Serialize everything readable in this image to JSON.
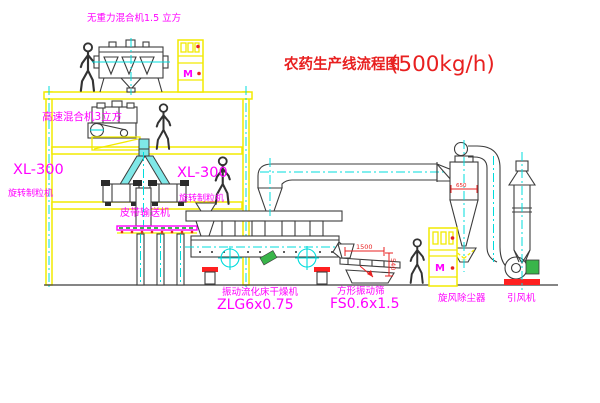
{
  "title": {
    "text": "农药生产线流程图",
    "capacity": "(500kg/h)"
  },
  "labels": {
    "zero_gravity_mixer": "无重力混合机1.5 立方",
    "high_speed_mixer": "高速混合机3立方",
    "granulator_left_model": "XL-300",
    "granulator_left_name": "旋转制粒机",
    "granulator_right_model": "XL-300",
    "granulator_right_name": "旋转制粒机",
    "belt_conveyor": "皮带输送机",
    "dryer_name": "振动流化床干燥机",
    "dryer_model": "ZLG6x0.75",
    "screen_name": "方形振动筛",
    "screen_model": "FS0.6x1.5",
    "cyclone": "旋风除尘器",
    "fan": "引风机",
    "cabinet_a_marking": "M",
    "cabinet_b_marking": "M"
  },
  "dimensions": {
    "screen_length": "1500",
    "screen_height": "540",
    "cyclone_diameter": "650"
  },
  "colors": {
    "building_yellow": "#f2ea00",
    "label_magenta": "#ff00ff",
    "title_red": "#e02020",
    "centerline_cyan": "#00dcdc",
    "equipment_gray": "#3c3c3c",
    "chute_cyan": "#7fe8e8",
    "motor_green": "#39b54a",
    "base_red": "#ff2020"
  }
}
